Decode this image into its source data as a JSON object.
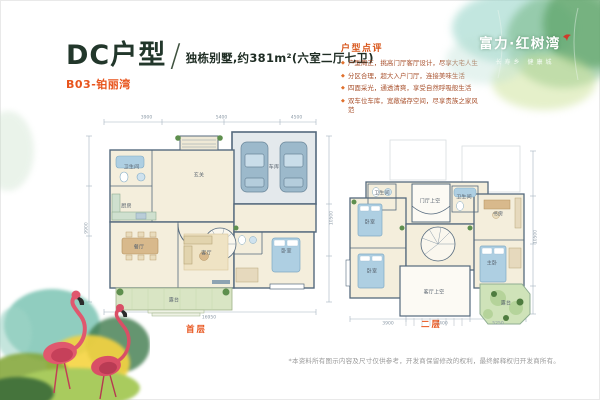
{
  "page": {
    "title": "DC户型",
    "separator": "/",
    "subtitle": "独栋别墅,约381m²(六室二厅七卫)",
    "unit_code": "B03-铂丽湾",
    "footnote": "*本资料所有图示内容及尺寸仅供参考，开发商保留修改的权利，最终解释权归开发商所有。"
  },
  "brand": {
    "name": "富力·红树湾",
    "tagline": "长寿乡 健康城",
    "bird_icon": "red-bird"
  },
  "review": {
    "heading": "户型点评",
    "bullet_glyph": "◆",
    "items": [
      "户型周正，挑高门厅客厅设计，尽享大宅人生",
      "分区合理，超大入户门厅，连接美味生活",
      "四面采光，通透清爽，享受自然呼吸般生活",
      "双车位车库，宽敞储存空间，尽享贵族之家风范"
    ]
  },
  "floorplans": [
    {
      "label": "首层",
      "rooms": [
        {
          "name": "车库",
          "x": 76,
          "y": 25
        },
        {
          "name": "卫生间",
          "x": 19,
          "y": 25
        },
        {
          "name": "厨房",
          "x": 17,
          "y": 44
        },
        {
          "name": "玄关",
          "x": 46,
          "y": 29
        },
        {
          "name": "餐厅",
          "x": 22,
          "y": 64
        },
        {
          "name": "客厅",
          "x": 49,
          "y": 67
        },
        {
          "name": "卧室",
          "x": 81,
          "y": 66
        },
        {
          "name": "露台",
          "x": 36,
          "y": 90
        }
      ],
      "dims": [
        {
          "t": "3900",
          "x": 25,
          "y": 1
        },
        {
          "t": "5400",
          "x": 55,
          "y": 1
        },
        {
          "t": "4500",
          "x": 85,
          "y": 1
        },
        {
          "t": "16950",
          "x": 50,
          "y": 99
        },
        {
          "t": "9900",
          "x": 1,
          "y": 55,
          "r": 1
        },
        {
          "t": "10500",
          "x": 99,
          "y": 50,
          "r": 1
        }
      ]
    },
    {
      "label": "二层",
      "rooms": [
        {
          "name": "门厅上空",
          "x": 46,
          "y": 34
        },
        {
          "name": "卫生间",
          "x": 22,
          "y": 30
        },
        {
          "name": "卫生间",
          "x": 63,
          "y": 32
        },
        {
          "name": "卧室",
          "x": 16,
          "y": 45
        },
        {
          "name": "卧室",
          "x": 17,
          "y": 71
        },
        {
          "name": "书房",
          "x": 80,
          "y": 41
        },
        {
          "name": "主卧",
          "x": 77,
          "y": 67
        },
        {
          "name": "客厅上空",
          "x": 48,
          "y": 82
        },
        {
          "name": "露台",
          "x": 84,
          "y": 88
        }
      ],
      "dims": [
        {
          "t": "3900",
          "x": 25,
          "y": 99
        },
        {
          "t": "5400",
          "x": 52,
          "y": 99
        },
        {
          "t": "5250",
          "x": 80,
          "y": 99
        },
        {
          "t": "10500",
          "x": 99,
          "y": 53,
          "r": 1
        }
      ]
    }
  ],
  "colors": {
    "accent_orange": "#e8541c",
    "title_dark": "#22372b",
    "review_text": "#a8502c",
    "wall": "#54697d",
    "floor_cream": "#f4eedc",
    "terrace_green": "#d9e5c4",
    "water_blue": "#aecfe2",
    "room_label": "#5a6570"
  }
}
